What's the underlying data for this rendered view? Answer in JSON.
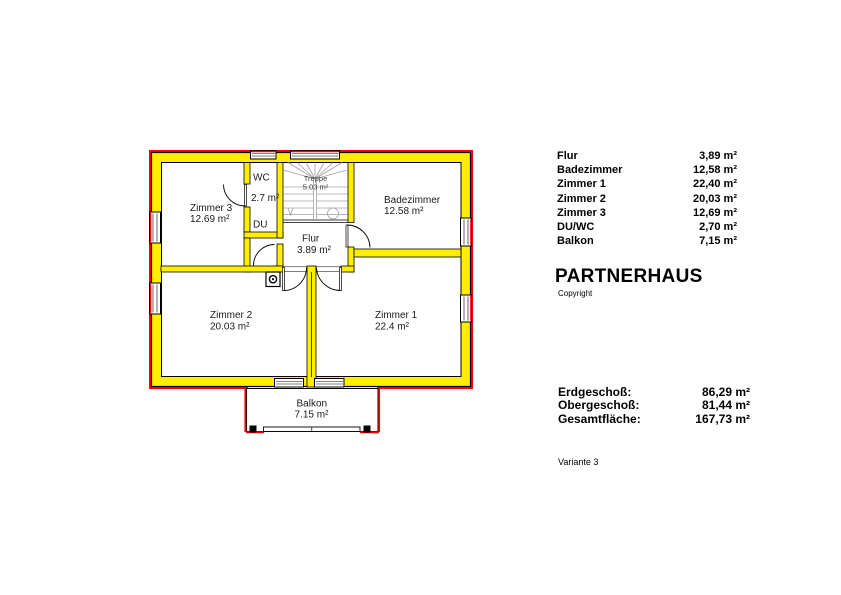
{
  "plan": {
    "colors": {
      "wall_fill": "#ffee00",
      "exterior_accent": "#ff0000",
      "stair_lines": "#a0a0a0",
      "outline": "#000000"
    },
    "rooms": {
      "zimmer3": {
        "name": "Zimmer 3",
        "area": "12.69 m²"
      },
      "wc": {
        "line1": "WC",
        "line2": "2.7 m²",
        "line3": "DU"
      },
      "treppe": {
        "name": "Treppe",
        "area": "5.03 m²"
      },
      "flur": {
        "name": "Flur",
        "area": "3.89 m²"
      },
      "badezimmer": {
        "name": "Badezimmer",
        "area": "12.58 m²"
      },
      "zimmer1": {
        "name": "Zimmer 1",
        "area": "22.4 m²"
      },
      "zimmer2": {
        "name": "Zimmer 2",
        "area": "20.03 m²"
      },
      "balkon": {
        "name": "Balkon",
        "area": "7.15 m²"
      }
    }
  },
  "panel": {
    "room_list": [
      {
        "label": "Flur",
        "value": "3,89 m²"
      },
      {
        "label": "Badezimmer",
        "value": "12,58 m²"
      },
      {
        "label": "Zimmer 1",
        "value": "22,40 m²"
      },
      {
        "label": "Zimmer 2",
        "value": "20,03 m²"
      },
      {
        "label": "Zimmer 3",
        "value": "12,69 m²"
      },
      {
        "label": "DU/WC",
        "value": "2,70 m²"
      },
      {
        "label": "Balkon",
        "value": "7,15 m²"
      }
    ],
    "title": "PARTNERHAUS",
    "copyright": "Copyright",
    "summary": [
      {
        "label": "Erdgeschoß:",
        "value": "86,29 m²"
      },
      {
        "label": "Obergeschoß:",
        "value": "81,44 m²"
      },
      {
        "label": "Gesamtfläche:",
        "value": "167,73 m²"
      }
    ],
    "variant": "Variante 3"
  }
}
